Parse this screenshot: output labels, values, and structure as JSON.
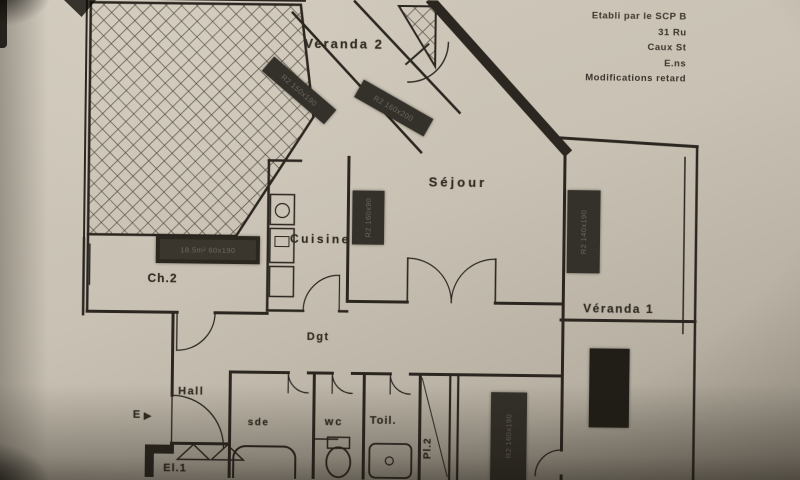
{
  "photo": {
    "paper_color": "#c9c2b4",
    "ink_color": "#2b2620",
    "sticker_color": "#34302a"
  },
  "header": {
    "lines": [
      "Etabli par le SCP B",
      "31 Ru",
      "Caux St",
      "E.ns",
      "Modifications retard"
    ]
  },
  "rooms": {
    "veranda2": "Veranda 2",
    "sejour": "Séjour",
    "cuisine": "Cuisine",
    "ch2": "Ch.2",
    "dgt": "Dgt",
    "hall": "Hall",
    "sde": "sde",
    "wc": "wc",
    "toil": "Toil.",
    "pl2": "Pl.2",
    "el1": "El.1",
    "veranda1": "Véranda 1",
    "entrance_label": "E",
    "entrance_arrow": "►"
  },
  "stickers": {
    "s1": "R2 150x190",
    "s2": "R2 160x200",
    "s3": "R2 160x90",
    "s4": "18.5m² 60x190",
    "s5": "R2 140x190",
    "s6": "",
    "s7": "R2 160x190"
  }
}
